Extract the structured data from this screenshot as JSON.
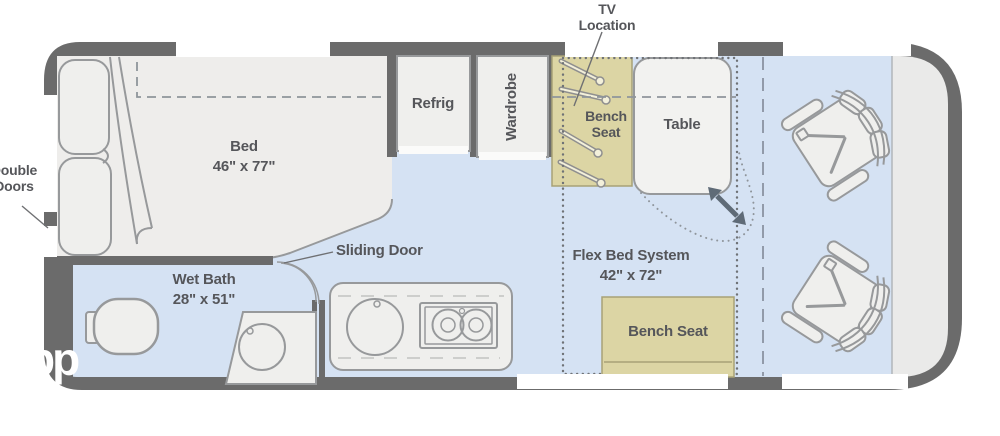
{
  "labels": {
    "tv_location": {
      "line1": "TV",
      "line2": "Location"
    },
    "double_doors": {
      "line1": "Double",
      "line2": "Doors"
    },
    "bed": {
      "name": "Bed",
      "dimensions": "46\" x 77\""
    },
    "refrig": "Refrig",
    "wardrobe": "Wardrobe",
    "bench_seat_top": {
      "line1": "Bench",
      "line2": "Seat"
    },
    "table": "Table",
    "sliding_door": "Sliding Door",
    "wet_bath": {
      "name": "Wet Bath",
      "dimensions": "28\" x 51\""
    },
    "flex_bed": {
      "name": "Flex Bed System",
      "dimensions": "42\" x 72\""
    },
    "bench_seat_bottom": "Bench Seat",
    "watermark": "pp"
  },
  "colors": {
    "wall": "#6b6b6b",
    "floor": "#d5e2f3",
    "cab_area": "#eaeae9",
    "furniture": "#efefed",
    "bench": "#dcd5a4",
    "window": "#ffffff",
    "text": "#55565a"
  }
}
